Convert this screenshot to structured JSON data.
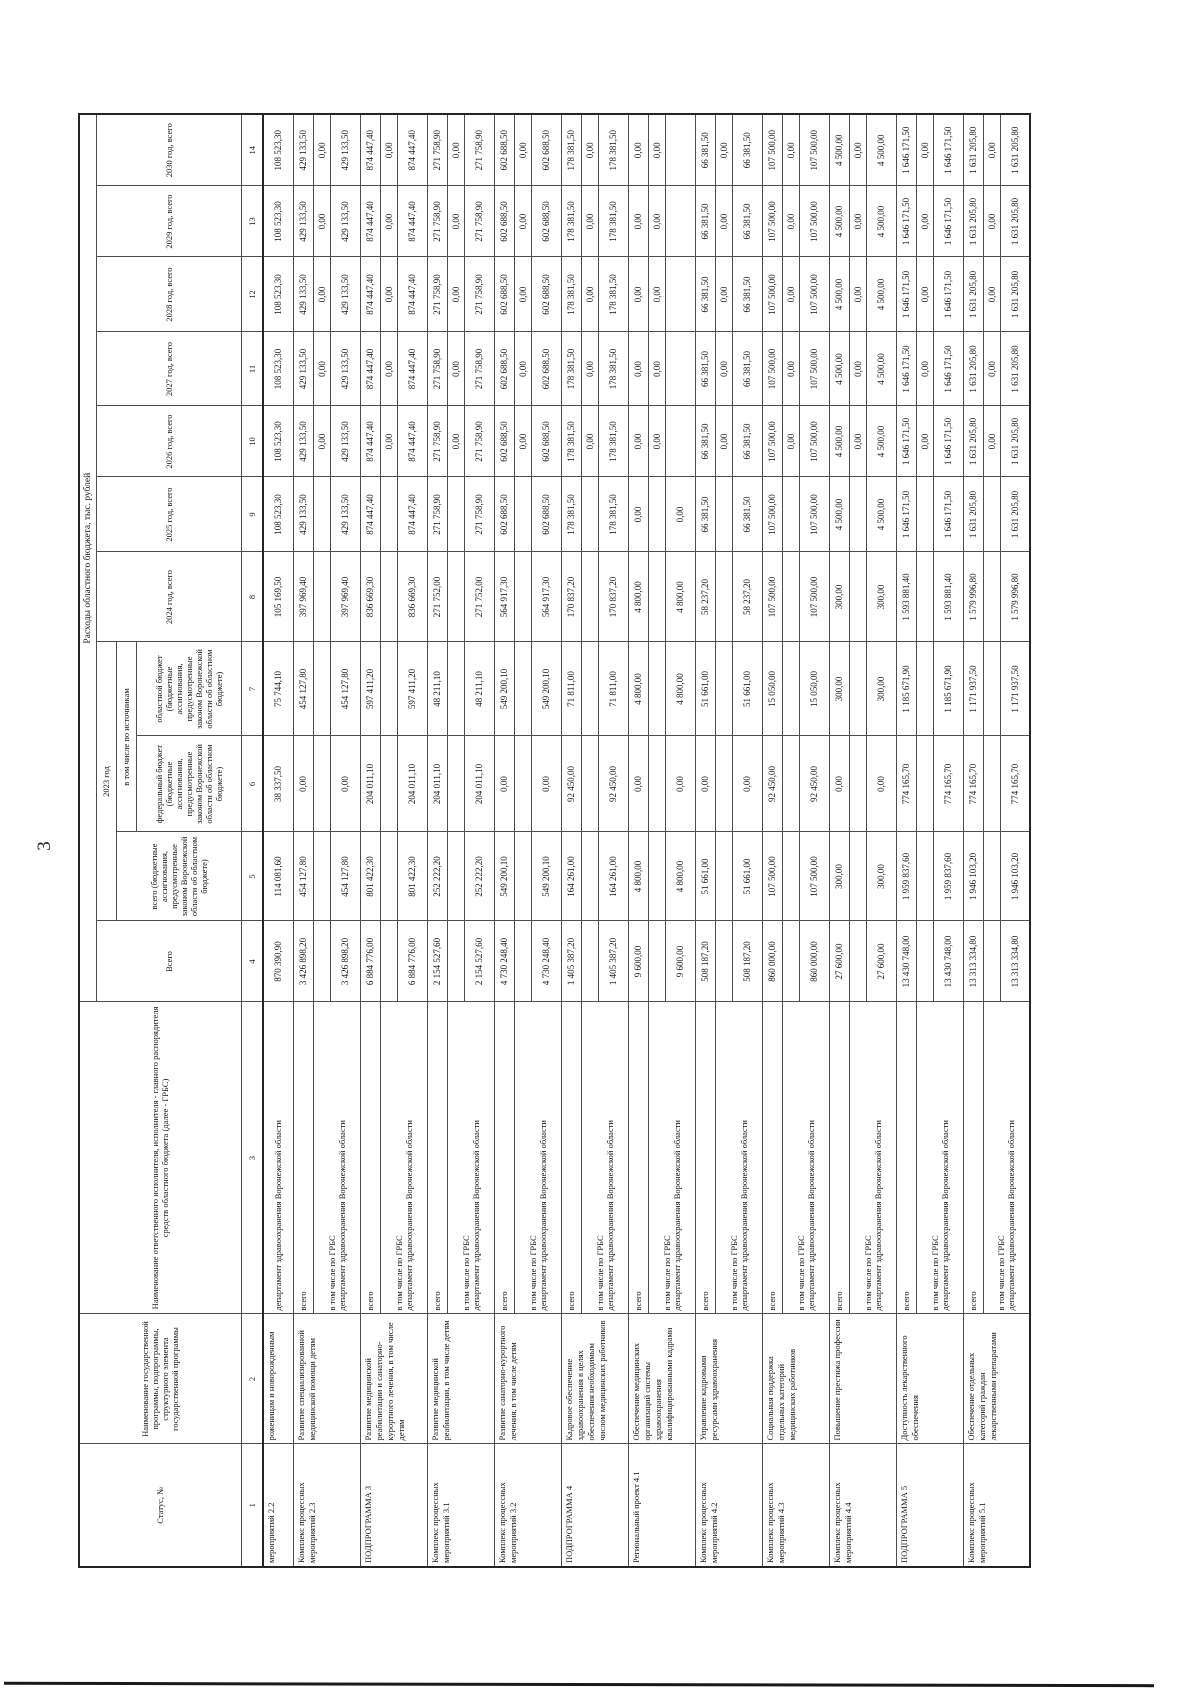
{
  "page": {
    "number": "3"
  },
  "table": {
    "top_header": "Расходы областного бюджета, тыс. рублей",
    "col_headers": {
      "status": "Статус, №",
      "program": "Наименование государственной программы, подпрограммы, структурного элемента государственной программы",
      "executor": "Наименование ответственного исполнителя, исполнителя - главного распорядителя средств областного бюджета (далее - ГРБС)",
      "total": "Всего",
      "year2023": "2023 год",
      "total2023": "всего (бюджетные ассигнования, предусмотренные законом Воронежской области об областном бюджете)",
      "by_sources": "в том числе по источникам",
      "federal": "федеральный бюджет (бюджетные ассигнования, предусмотренные законом Воронежской области об областном бюджете)",
      "regional": "областной бюджет (бюджетные ассигнования, предусмотренные законом Воронежской области об областном бюджете)",
      "years": [
        "2024 год, всего",
        "2025 год, всего",
        "2026 год, всего",
        "2027 год, всего",
        "2028 год, всего",
        "2029 год, всего",
        "2030 год, всего"
      ]
    },
    "column_numbers": [
      "1",
      "2",
      "3",
      "4",
      "5",
      "6",
      "7",
      "8",
      "9",
      "10",
      "11",
      "12",
      "13",
      "14"
    ],
    "executor_labels": {
      "total": "всего",
      "grbs": "в том числе по ГРБС",
      "department": "департамент здравоохранения Воронежской области"
    },
    "blocks": [
      {
        "status": "мероприятий 2.2",
        "program": "роженицам и новорожденным",
        "partial": true,
        "dep": [
          "870 390,90",
          "114 081,60",
          "38 337,50",
          "75 744,10",
          "105 169,50",
          "108 523,30",
          "108 523,30",
          "108 523,30",
          "108 523,30",
          "108 523,30",
          "108 523,30"
        ]
      },
      {
        "status": "Комплекс процессных мероприятий 2.3",
        "program": "Развитие специализированной медицинской помощи детям",
        "total": [
          "3 426 898,20",
          "454 127,80",
          "0,00",
          "454 127,80",
          "397 969,40",
          "429 133,50",
          "429 133,50",
          "429 133,50",
          "429 133,50",
          "429 133,50",
          "429 133,50"
        ],
        "mid": [
          "",
          "",
          "",
          "",
          "",
          "",
          "0,00",
          "0,00",
          "0,00",
          "0,00",
          "0,00"
        ],
        "dep": [
          "3 426 898,20",
          "454 127,80",
          "0,00",
          "454 127,80",
          "397 969,40",
          "429 133,50",
          "429 133,50",
          "429 133,50",
          "429 133,50",
          "429 133,50",
          "429 133,50"
        ]
      },
      {
        "status": "ПОДПРОГРАММА 3",
        "program": "Развитие медицинской реабилитации и санаторно-курортного лечения, в том числе детям",
        "total": [
          "6 884 776,00",
          "801 422,30",
          "204 011,10",
          "597 411,20",
          "836 669,30",
          "874 447,40",
          "874 447,40",
          "874 447,40",
          "874 447,40",
          "874 447,40",
          "874 447,40"
        ],
        "mid": [
          "",
          "",
          "",
          "",
          "",
          "",
          "0,00",
          "0,00",
          "0,00",
          "0,00",
          "0,00"
        ],
        "dep": [
          "6 884 776,00",
          "801 422,30",
          "204 011,10",
          "597 411,20",
          "836 669,30",
          "874 447,40",
          "874 447,40",
          "874 447,40",
          "874 447,40",
          "874 447,40",
          "874 447,40"
        ]
      },
      {
        "status": "Комплекс процессных мероприятий 3.1",
        "program": "Развитие медицинской реабилитации, в том числе детям",
        "total": [
          "2 154 527,60",
          "252 222,20",
          "204 011,10",
          "48 211,10",
          "271 752,00",
          "271 758,90",
          "271 758,90",
          "271 758,90",
          "271 758,90",
          "271 758,90",
          "271 758,90"
        ],
        "mid": [
          "",
          "",
          "",
          "",
          "",
          "",
          "0,00",
          "0,00",
          "0,00",
          "0,00",
          "0,00"
        ],
        "dep": [
          "2 154 527,60",
          "252 222,20",
          "204 011,10",
          "48 211,10",
          "271 752,00",
          "271 758,90",
          "271 758,90",
          "271 758,90",
          "271 758,90",
          "271 758,90",
          "271 758,90"
        ]
      },
      {
        "status": "Комплекс процессных мероприятий 3.2",
        "program": "Развитие санаторно-курортного лечения, в том числе детям",
        "total": [
          "4 730 248,40",
          "549 200,10",
          "0,00",
          "549 200,10",
          "564 917,30",
          "602 688,50",
          "602 688,50",
          "602 688,50",
          "602 688,50",
          "602 688,50",
          "602 688,50"
        ],
        "mid": [
          "",
          "",
          "",
          "",
          "",
          "",
          "0,00",
          "0,00",
          "0,00",
          "0,00",
          "0,00"
        ],
        "dep": [
          "4 730 248,40",
          "549 200,10",
          "0,00",
          "549 200,10",
          "564 917,30",
          "602 688,50",
          "602 688,50",
          "602 688,50",
          "602 688,50",
          "602 688,50",
          "602 688,50"
        ]
      },
      {
        "status": "ПОДПРОГРАММА 4",
        "program": "Кадровое обеспечение здравоохранения в целях обеспечения необходимым числом медицинских работников",
        "total": [
          "1 405 387,20",
          "164 261,00",
          "92 450,00",
          "71 811,00",
          "170 837,20",
          "178 381,50",
          "178 381,50",
          "178 381,50",
          "178 381,50",
          "178 381,50",
          "178 381,50"
        ],
        "mid": [
          "",
          "",
          "",
          "",
          "",
          "",
          "0,00",
          "0,00",
          "0,00",
          "0,00",
          "0,00"
        ],
        "dep": [
          "1 405 387,20",
          "164 261,00",
          "92 450,00",
          "71 811,00",
          "170 837,20",
          "178 381,50",
          "178 381,50",
          "178 381,50",
          "178 381,50",
          "178 381,50",
          "178 381,50"
        ]
      },
      {
        "status": "Региональный проект 4.1",
        "program": "Обеспечение медицинских организаций системы здравоохранения квалифицированными кадрами",
        "total": [
          "9 600,00",
          "4 800,00",
          "0,00",
          "4 800,00",
          "4 800,00",
          "0,00",
          "0,00",
          "0,00",
          "0,00",
          "0,00",
          "0,00"
        ],
        "mid": [
          "",
          "",
          "",
          "",
          "",
          "",
          "0,00",
          "0,00",
          "0,00",
          "0,00",
          "0,00"
        ],
        "dep": [
          "9 600,00",
          "4 800,00",
          "0,00",
          "4 800,00",
          "4 800,00",
          "0,00",
          "",
          "",
          "",
          "",
          ""
        ]
      },
      {
        "status": "Комплекс процессных мероприятий 4.2",
        "program": "Управление кадровыми ресурсами здравоохранения",
        "total": [
          "508 187,20",
          "51 661,00",
          "0,00",
          "51 661,00",
          "58 237,20",
          "66 381,50",
          "66 381,50",
          "66 381,50",
          "66 381,50",
          "66 381,50",
          "66 381,50"
        ],
        "mid": [
          "",
          "",
          "",
          "",
          "",
          "",
          "0,00",
          "0,00",
          "0,00",
          "0,00",
          "0,00"
        ],
        "dep": [
          "508 187,20",
          "51 661,00",
          "0,00",
          "51 661,00",
          "58 237,20",
          "66 381,50",
          "66 381,50",
          "66 381,50",
          "66 381,50",
          "66 381,50",
          "66 381,50"
        ]
      },
      {
        "status": "Комплекс процессных мероприятий 4.3",
        "program": "Социальная поддержка отдельных категорий медицинских работников",
        "total": [
          "860 000,00",
          "107 500,00",
          "92 450,00",
          "15 050,00",
          "107 500,00",
          "107 500,00",
          "107 500,00",
          "107 500,00",
          "107 500,00",
          "107 500,00",
          "107 500,00"
        ],
        "mid": [
          "",
          "",
          "",
          "",
          "",
          "",
          "0,00",
          "0,00",
          "0,00",
          "0,00",
          "0,00"
        ],
        "dep": [
          "860 000,00",
          "107 500,00",
          "92 450,00",
          "15 050,00",
          "107 500,00",
          "107 500,00",
          "107 500,00",
          "107 500,00",
          "107 500,00",
          "107 500,00",
          "107 500,00"
        ]
      },
      {
        "status": "Комплекс процессных мероприятий 4.4",
        "program": "Повышение престижа профессии",
        "total": [
          "27 600,00",
          "300,00",
          "0,00",
          "300,00",
          "300,00",
          "4 500,00",
          "4 500,00",
          "4 500,00",
          "4 500,00",
          "4 500,00",
          "4 500,00"
        ],
        "mid": [
          "",
          "",
          "",
          "",
          "",
          "",
          "0,00",
          "0,00",
          "0,00",
          "0,00",
          "0,00"
        ],
        "dep": [
          "27 600,00",
          "300,00",
          "0,00",
          "300,00",
          "300,00",
          "4 500,00",
          "4 500,00",
          "4 500,00",
          "4 500,00",
          "4 500,00",
          "4 500,00"
        ]
      },
      {
        "status": "ПОДПРОГРАММА 5",
        "program": "Доступность лекарственного обеспечения",
        "total": [
          "13 430 748,00",
          "1 959 837,60",
          "774 165,70",
          "1 185 671,90",
          "1 593 881,40",
          "1 646 171,50",
          "1 646 171,50",
          "1 646 171,50",
          "1 646 171,50",
          "1 646 171,50",
          "1 646 171,50"
        ],
        "mid": [
          "",
          "",
          "",
          "",
          "",
          "",
          "0,00",
          "0,00",
          "0,00",
          "0,00",
          "0,00"
        ],
        "dep": [
          "13 430 748,00",
          "1 959 837,60",
          "774 165,70",
          "1 185 671,90",
          "1 593 881,40",
          "1 646 171,50",
          "1 646 171,50",
          "1 646 171,50",
          "1 646 171,50",
          "1 646 171,50",
          "1 646 171,50"
        ]
      },
      {
        "status": "Комплекс процессных мероприятий 5.1",
        "program": "Обеспечение отдельных категорий граждан лекарственными препаратами",
        "total": [
          "13 313 334,80",
          "1 946 103,20",
          "774 165,70",
          "1 171 937,50",
          "1 579 996,80",
          "1 631 205,80",
          "1 631 205,80",
          "1 631 205,80",
          "1 631 205,80",
          "1 631 205,80",
          "1 631 205,80"
        ],
        "mid": [
          "",
          "",
          "",
          "",
          "",
          "",
          "0,00",
          "0,00",
          "0,00",
          "0,00",
          "0,00"
        ],
        "dep": [
          "13 313 334,80",
          "1 946 103,20",
          "774 165,70",
          "1 171 937,50",
          "1 579 996,80",
          "1 631 205,80",
          "1 631 205,80",
          "1 631 205,80",
          "1 631 205,80",
          "1 631 205,80",
          "1 631 205,80"
        ]
      }
    ]
  }
}
